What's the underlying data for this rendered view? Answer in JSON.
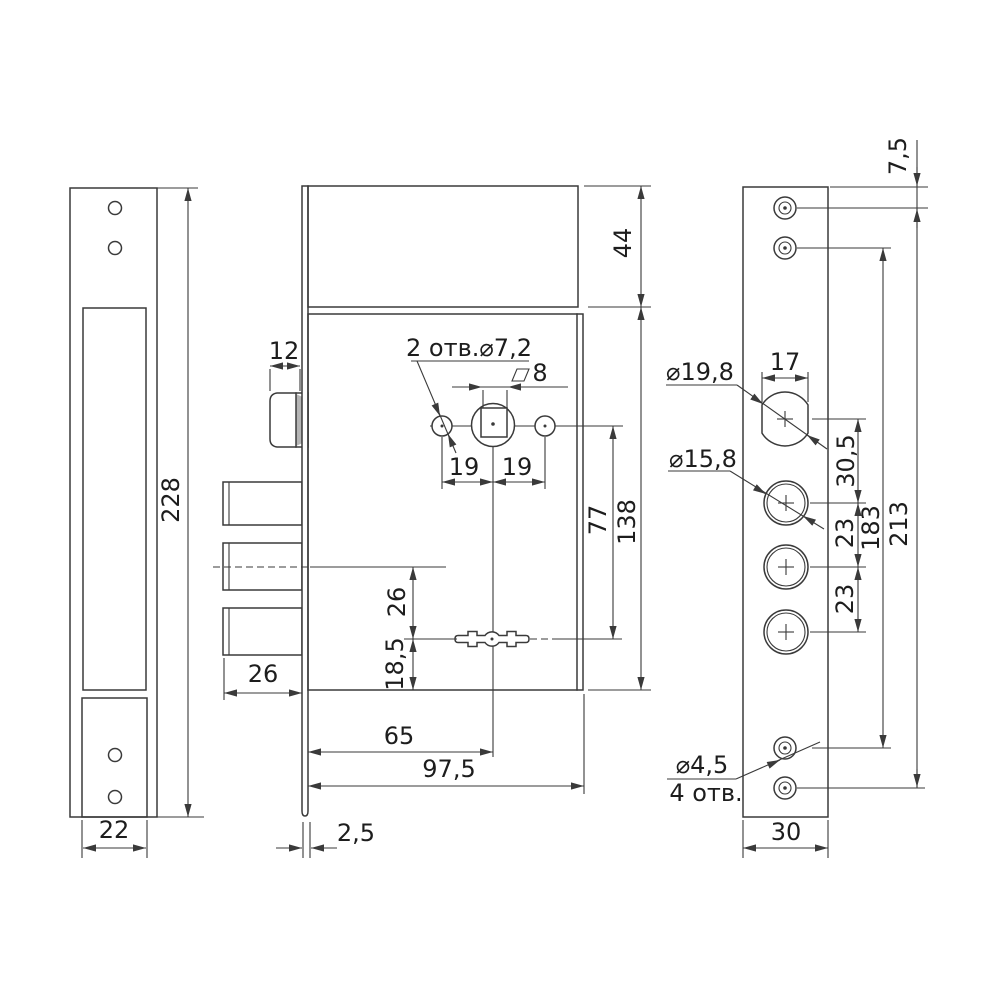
{
  "colors": {
    "line": "#3a3a3a",
    "text": "#1d1d1d",
    "background": "#ffffff"
  },
  "strike_plate": {
    "height": "228",
    "box_width": "22"
  },
  "lock_body": {
    "latch_width": "12",
    "spindle_holes": "2 отв.⌀7,2",
    "square_size": "8",
    "pitch_left": "19",
    "pitch_right": "19",
    "top_height": "44",
    "spindle_to_keyhole": "77",
    "body_height": "138",
    "bolt_axis_to_keyhole": "26",
    "keyhole_to_bottom": "18,5",
    "bolt_width": "26",
    "backset": "65",
    "body_width": "97,5",
    "faceplate_thickness": "2,5"
  },
  "faceplate": {
    "top_to_screw": "7,5",
    "cylinder_dia": "⌀19,8",
    "cylinder_width": "17",
    "cylinder_to_hole": "30,5",
    "hole_dia": "⌀15,8",
    "pitch_a": "23",
    "pitch_b": "23",
    "screw_pitch_inner": "183",
    "screw_pitch_outer": "213",
    "screw_dia": "⌀4,5",
    "screw_count": "4 отв.",
    "width": "30"
  }
}
